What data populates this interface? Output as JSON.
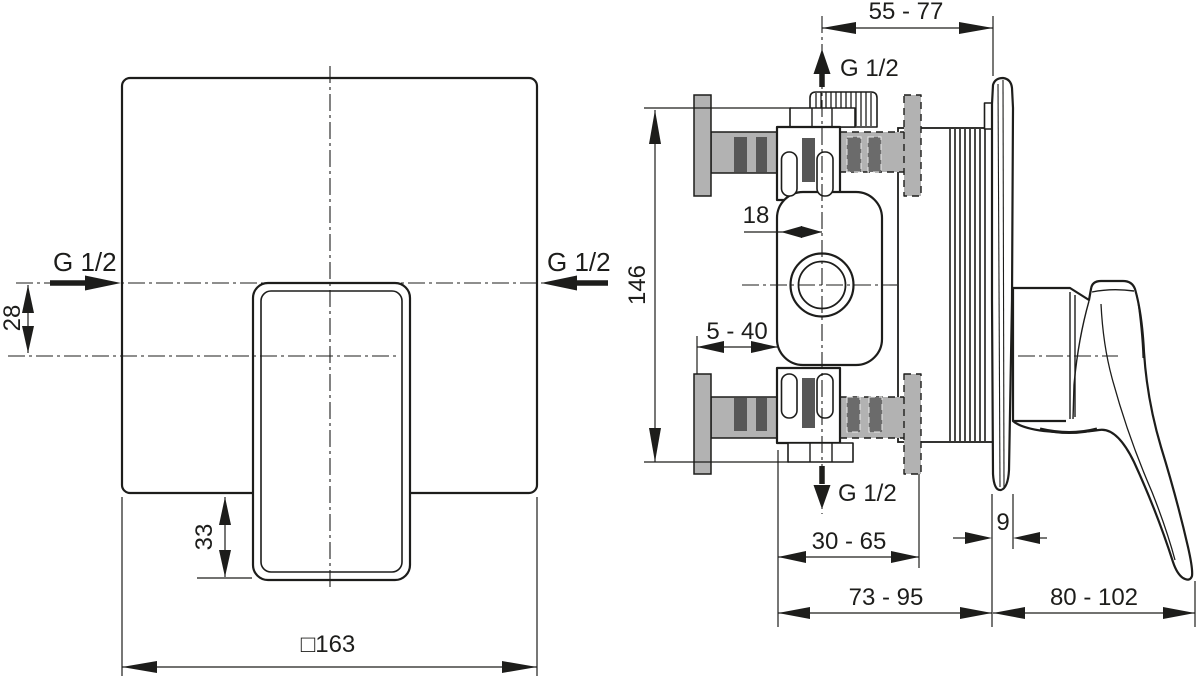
{
  "drawing_title": "concealed-shower-mixer-dimension-drawing",
  "colors": {
    "line": "#1d1d1b",
    "wall_gray": "#b2b2b2",
    "bar_dark": "#575757",
    "bar_mid": "#6b6b6b",
    "white": "#ffffff"
  },
  "front_view": {
    "thread_left": "G 1/2",
    "thread_right": "G 1/2",
    "dim_offset": "28",
    "dim_handle_drop": "33",
    "dim_plate_square": "□163"
  },
  "side_view": {
    "dim_depth_top": "55 - 77",
    "thread_top": "G 1/2",
    "dim_height": "146",
    "dim_center_offset": "18",
    "dim_wall_min_max": "5 - 40",
    "thread_bottom": "G 1/2",
    "dim_rough_in": "30 - 65",
    "dim_plate_thickness": "9",
    "dim_total_rough": "73 - 95",
    "dim_trim_depth": "80 - 102"
  }
}
